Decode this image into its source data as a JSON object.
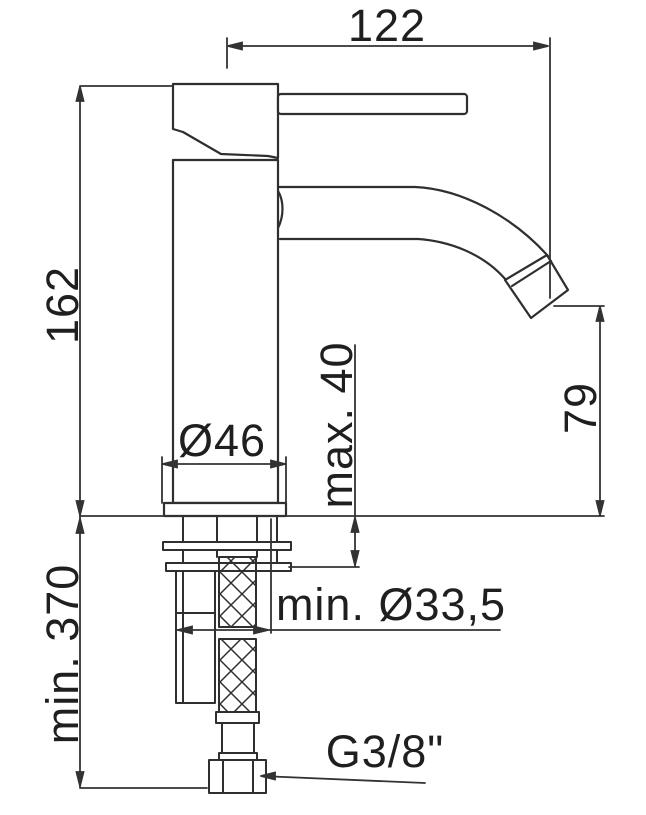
{
  "colors": {
    "background": "#ffffff",
    "line": "#2f2f2f",
    "text": "#1f1f1f"
  },
  "dimensions": {
    "spout_reach": "122",
    "total_height": "162",
    "hose_min_length": "min. 370",
    "base_diameter": "Ø46",
    "max_mounting_thickness": "max. 40",
    "spout_outlet_height": "79",
    "min_hole_diameter": "min. Ø33,5",
    "thread": "G3/8\""
  }
}
